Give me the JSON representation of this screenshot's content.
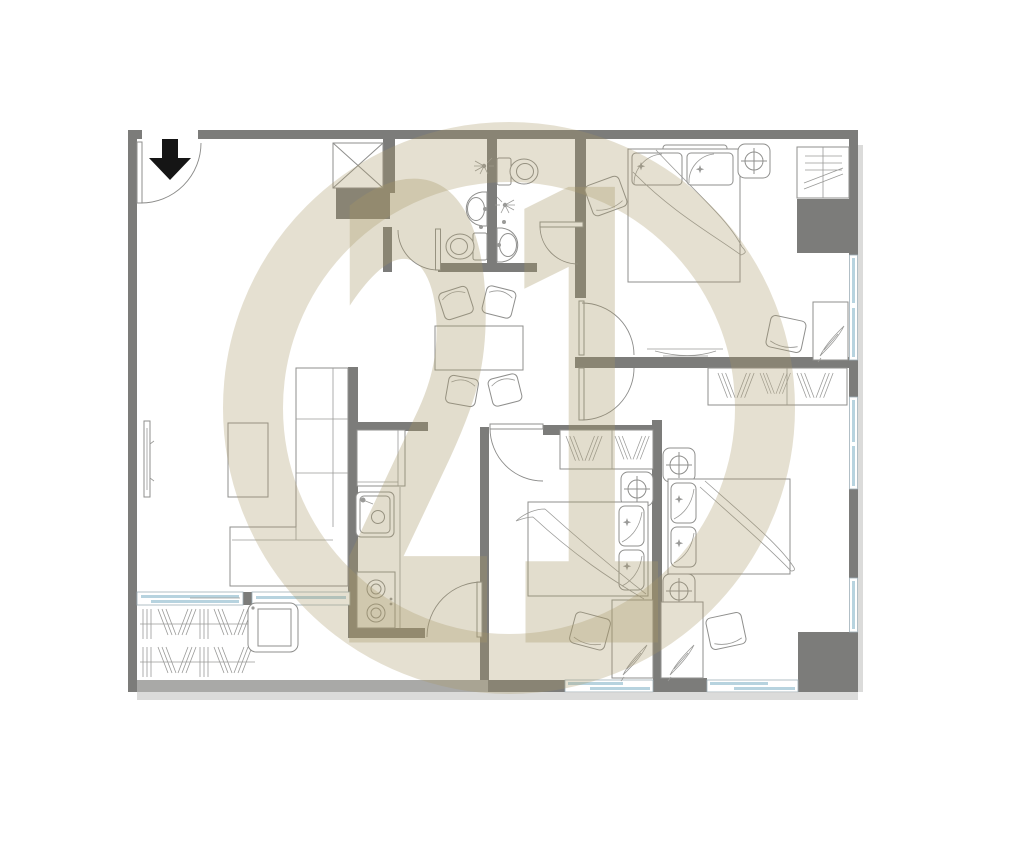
{
  "watermark": {
    "text": "21",
    "brand": "circled-21-watermark"
  },
  "colors": {
    "background": "#ffffff",
    "wall": "#7c7c7a",
    "balcony_parapet": "#a9a9a7",
    "furniture_line": "#8f8f8d",
    "window_glass": "#b7d3df",
    "watermark_beige": "#a89868",
    "entrance_arrow": "#151515",
    "shadow": "#cfcfcd"
  },
  "plan": {
    "type": "apartment-floor-plan",
    "entrance": {
      "symbol": "down-arrow",
      "location": "top-left"
    },
    "rooms": [
      {
        "name": "living-room",
        "furniture": [
          "wall-tv",
          "coffee-table",
          "l-shaped-sofa"
        ]
      },
      {
        "name": "dining-area",
        "furniture": [
          "dining-table",
          "stool",
          "stool",
          "stool",
          "stool"
        ]
      },
      {
        "name": "kitchen",
        "furniture": [
          "refrigerator",
          "kitchen-sink",
          "counter",
          "two-burner-stove"
        ]
      },
      {
        "name": "bathroom-left",
        "furniture": [
          "shower-head",
          "wash-basin",
          "toilet"
        ]
      },
      {
        "name": "bathroom-right",
        "furniture": [
          "toilet",
          "shower-head",
          "wash-basin"
        ]
      },
      {
        "name": "bedroom-top-right",
        "furniture": [
          "double-bed",
          "pillow",
          "pillow",
          "ceiling-light",
          "closet-shelves",
          "rug",
          "desk",
          "chair",
          "wall-tv"
        ]
      },
      {
        "name": "bedroom-bottom-middle",
        "furniture": [
          "wardrobe-hangers",
          "air-conditioner",
          "double-bed",
          "pillow",
          "pillow",
          "chair",
          "desk"
        ]
      },
      {
        "name": "bedroom-bottom-right",
        "furniture": [
          "wardrobe-hangers",
          "air-conditioner",
          "air-conditioner",
          "double-bed",
          "pillow",
          "pillow",
          "chair",
          "desk"
        ]
      },
      {
        "name": "balcony",
        "furniture": [
          "plants",
          "washing-machine"
        ]
      },
      {
        "name": "utility-shaft",
        "symbol": "crossed-box"
      }
    ],
    "windows": [
      "balcony-sliding-door",
      "bedroom-top-right-side-window",
      "bedroom-bottom-right-side-window-upper",
      "bedroom-bottom-right-side-window-lower",
      "bedroom-bottom-middle-bottom-window",
      "bedroom-bottom-right-bottom-window"
    ]
  }
}
